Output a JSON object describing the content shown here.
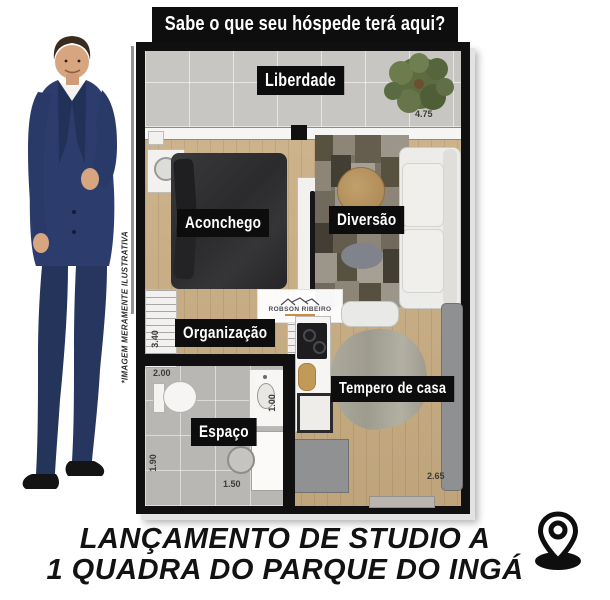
{
  "banner": {
    "text": "Sabe o que seu hóspede terá aqui?"
  },
  "disclaimer": {
    "text": "*IMAGEM MERAMENTE ILUSTRATIVA"
  },
  "plan": {
    "labels": {
      "balcony": "Liberdade",
      "sleep": "Aconchego",
      "living": "Diversão",
      "closet": "Organização",
      "bath": "Espaço",
      "kitchen": "Tempero de casa"
    },
    "dims": {
      "balcony_w": "4.75",
      "closet_h": "3.40",
      "bath_w_top": "2.00",
      "bath_h": "1.90",
      "bath_w_bottom": "1.50",
      "shower_w": "1.00",
      "dining_h": "2.65"
    },
    "watermark": {
      "name": "ROBSON RIBEIRO"
    }
  },
  "headline": {
    "line1": "LANÇAMENTO DE STUDIO A",
    "line2": "1 QUADRA DO PARQUE DO INGÁ"
  },
  "colors": {
    "ink": "#0e0e0e",
    "wood_floor": "#c9ad82",
    "balcony_tile": "#c7c6c2",
    "bath_tile": "#b8b7b4",
    "suit_navy": "#2c3d6d"
  }
}
